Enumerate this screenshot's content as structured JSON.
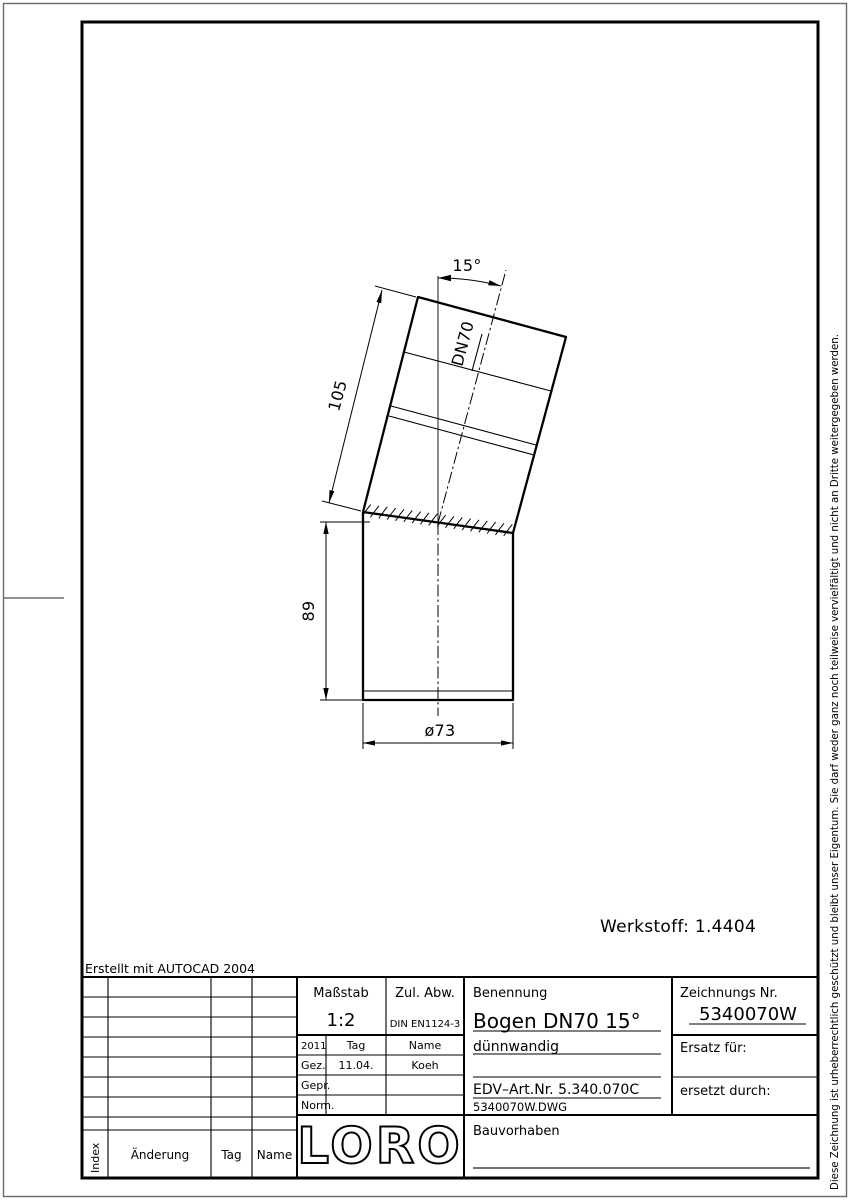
{
  "page": {
    "copyright_vertical": "Diese Zeichnung ist urheberrechtlich geschützt und bleibt unser Eigentum. Sie darf weder ganz noch teilweise vervielfältigt und nicht an Dritte weitergegeben werden.",
    "created_with": "Erstellt mit AUTOCAD 2004",
    "werkstoff": "Werkstoff:  1.4404"
  },
  "drawing": {
    "angle_label": "15°",
    "dn_label": "DN70",
    "dim_upper_length": "105",
    "dim_lower_length": "89",
    "dim_diameter": "ø73"
  },
  "title_block": {
    "masstab_label": "Maßstab",
    "masstab_value": "1:2",
    "zul_abw_label": "Zul. Abw.",
    "zul_abw_value": "DIN EN1124-3",
    "benennung_label": "Benennung",
    "benennung_value": "Bogen DN70 15°",
    "zeichnungs_nr_label": "Zeichnungs Nr.",
    "zeichnungs_nr_value": "5340070W",
    "year": "2011",
    "tag_col_label": "Tag",
    "name_col_label": "Name",
    "gez_label": "Gez.",
    "gez_tag": "11.04.",
    "gez_name": "Koeh",
    "gepr_label": "Gepr.",
    "norm_label": "Norm.",
    "desc_line1": "dünnwandig",
    "edv_art_nr": "EDV–Art.Nr.  5.340.070C",
    "dwg_file": "5340070W.DWG",
    "ersatz_fuer_label": "Ersatz für:",
    "ersetzt_durch_label": "ersetzt durch:",
    "bauvorhaben_label": "Bauvorhaben",
    "logo": "LORO"
  },
  "revision_table": {
    "index_label": "Index",
    "aenderung_label": "Änderung",
    "tag_label": "Tag",
    "name_label": "Name"
  }
}
